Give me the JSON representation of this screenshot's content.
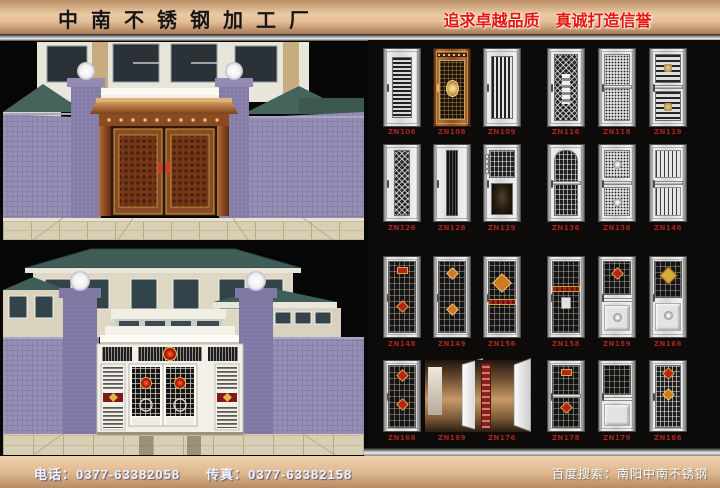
{
  "header": {
    "company_name": "中南不锈钢加工厂",
    "slogan": "追求卓越品质　真诚打造信誉"
  },
  "footer": {
    "phone": "电话：0377-63382058",
    "fax": "传真：0377-63382158",
    "search_hint": "百度搜索：南阳中南不锈钢"
  },
  "colors": {
    "header_bg_light": "#ecc9a3",
    "header_bg_dark": "#a87c57",
    "slogan_red": "#e8150d",
    "model_label_red": "#a8241c",
    "panel_bg": "#0d0b09",
    "wall_purple": "#968fb4",
    "roof_teal": "#3f5e57",
    "copper": "#8c4f24",
    "pavement_beige": "#d8cfb5"
  },
  "scenes": {
    "top": "copper-gate-building-rendering",
    "bottom": "stainless-gate-building-rendering"
  },
  "catalog": {
    "rows": [
      {
        "doors": [
          {
            "model": "ZN106",
            "base": "silver",
            "parts": [
              {
                "t": "hstripes",
                "top": 11,
                "h": 78
              }
            ]
          },
          {
            "model": "ZN108",
            "base": "copper",
            "parts": [
              {
                "t": "studrow",
                "top": 5,
                "h": 5
              },
              {
                "t": "copperfield",
                "top": 14,
                "h": 78
              },
              {
                "t": "goldoval",
                "top": 40
              }
            ]
          },
          {
            "model": "ZN109",
            "base": "silver",
            "parts": [
              {
                "t": "vslats",
                "top": 9,
                "h": 82
              }
            ]
          },
          {
            "model": "ZN116",
            "base": "silver",
            "parts": [
              {
                "t": "dmesh",
                "top": 7,
                "h": 86
              },
              {
                "t": "lightchain",
                "top": 32
              }
            ]
          },
          {
            "model": "ZN118",
            "base": "silver",
            "parts": [
              {
                "t": "dots",
                "top": 7,
                "h": 86
              },
              {
                "t": "band",
                "top": 47
              }
            ]
          },
          {
            "model": "ZN119",
            "base": "silver",
            "parts": [
              {
                "t": "hlines",
                "top": 7,
                "h": 37
              },
              {
                "t": "goldemblem",
                "top": 20
              },
              {
                "t": "band",
                "top": 47
              },
              {
                "t": "hlines",
                "top": 55,
                "h": 38
              },
              {
                "t": "goldemblem",
                "top": 70
              }
            ]
          }
        ]
      },
      {
        "doors": [
          {
            "model": "ZN126",
            "base": "silver",
            "parts": [
              {
                "t": "dmesh2",
                "top": 7,
                "h": 86
              }
            ]
          },
          {
            "model": "ZN128",
            "base": "silver",
            "parts": [
              {
                "t": "darkstrip",
                "top": 7,
                "h": 86
              }
            ]
          },
          {
            "model": "ZN129",
            "base": "silver",
            "parts": [
              {
                "t": "intercom",
                "top": 12
              },
              {
                "t": "grille",
                "top": 7,
                "h": 36
              },
              {
                "t": "darkart",
                "top": 50,
                "h": 42
              }
            ]
          },
          {
            "model": "ZN136",
            "base": "silver",
            "parts": [
              {
                "t": "archgrille",
                "top": 6,
                "h": 88
              },
              {
                "t": "band",
                "top": 47
              }
            ]
          },
          {
            "model": "ZN138",
            "base": "silver",
            "parts": [
              {
                "t": "dots",
                "top": 7,
                "h": 37
              },
              {
                "t": "rosette",
                "top": 20
              },
              {
                "t": "band",
                "top": 47
              },
              {
                "t": "dots",
                "top": 55,
                "h": 38
              },
              {
                "t": "rosette",
                "top": 70
              }
            ]
          },
          {
            "model": "ZN146",
            "base": "silver",
            "parts": [
              {
                "t": "vlines",
                "top": 7,
                "h": 37
              },
              {
                "t": "band",
                "top": 47
              },
              {
                "t": "vlines",
                "top": 55,
                "h": 38
              }
            ]
          }
        ]
      },
      {
        "doors": [
          {
            "model": "ZN148",
            "base": "silver",
            "parts": [
              {
                "t": "darkgrille",
                "top": 5,
                "h": 90
              },
              {
                "t": "redrect",
                "top": 12
              },
              {
                "t": "reddiamond",
                "top": 56
              }
            ]
          },
          {
            "model": "ZN149",
            "base": "silver",
            "parts": [
              {
                "t": "darkgrille",
                "top": 5,
                "h": 90
              },
              {
                "t": "orangediamond",
                "top": 15
              },
              {
                "t": "orangediamond",
                "top": 60
              }
            ]
          },
          {
            "model": "ZN156",
            "base": "silver",
            "parts": [
              {
                "t": "darkgrille",
                "top": 5,
                "h": 90
              },
              {
                "t": "bigdiamond",
                "top": 24
              },
              {
                "t": "redband",
                "top": 52
              }
            ]
          },
          {
            "model": "ZN158",
            "base": "silver",
            "parts": [
              {
                "t": "darkgrille",
                "top": 5,
                "h": 90
              },
              {
                "t": "redband",
                "top": 36
              },
              {
                "t": "lightsq",
                "top": 50
              }
            ]
          },
          {
            "model": "ZN159",
            "base": "silver",
            "parts": [
              {
                "t": "darkgrille",
                "top": 5,
                "h": 42
              },
              {
                "t": "reddiamond",
                "top": 15
              },
              {
                "t": "hlines3",
                "top": 51
              },
              {
                "t": "emboss",
                "top": 60,
                "h": 33
              },
              {
                "t": "rosette",
                "top": 70
              }
            ]
          },
          {
            "model": "ZN166",
            "base": "silver",
            "parts": [
              {
                "t": "darkgrille",
                "top": 5,
                "h": 46
              },
              {
                "t": "golddiamond",
                "top": 15
              },
              {
                "t": "emboss",
                "top": 57,
                "h": 36
              },
              {
                "t": "rosette",
                "top": 68
              }
            ]
          }
        ]
      },
      {
        "doors": [
          {
            "model": "ZN168",
            "base": "silver",
            "parts": [
              {
                "t": "darkgrille",
                "top": 5,
                "h": 90
              },
              {
                "t": "reddiamond",
                "top": 14
              },
              {
                "t": "reddiamond",
                "top": 55
              }
            ]
          },
          {
            "model": "ZN169",
            "base": "open",
            "parts": [
              {
                "t": "interior"
              },
              {
                "t": "mirror"
              },
              {
                "t": "leaf"
              }
            ]
          },
          {
            "model": "ZN176",
            "base": "open",
            "parts": [
              {
                "t": "interior"
              },
              {
                "t": "redstrip"
              },
              {
                "t": "leaf2"
              }
            ]
          },
          {
            "model": "ZN178",
            "base": "silver",
            "parts": [
              {
                "t": "darkgrille",
                "top": 5,
                "h": 90
              },
              {
                "t": "redrect",
                "top": 12
              },
              {
                "t": "band",
                "top": 47
              },
              {
                "t": "reddiamond",
                "top": 60
              }
            ]
          },
          {
            "model": "ZN179",
            "base": "silver",
            "parts": [
              {
                "t": "darkgrille",
                "top": 5,
                "h": 44
              },
              {
                "t": "hlines3",
                "top": 52
              },
              {
                "t": "emboss",
                "top": 61,
                "h": 32
              }
            ]
          },
          {
            "model": "ZN186",
            "base": "silver",
            "parts": [
              {
                "t": "grille",
                "top": 5,
                "h": 90
              },
              {
                "t": "reddiamond",
                "top": 12
              },
              {
                "t": "orangediamond",
                "top": 42
              }
            ]
          }
        ]
      }
    ]
  }
}
